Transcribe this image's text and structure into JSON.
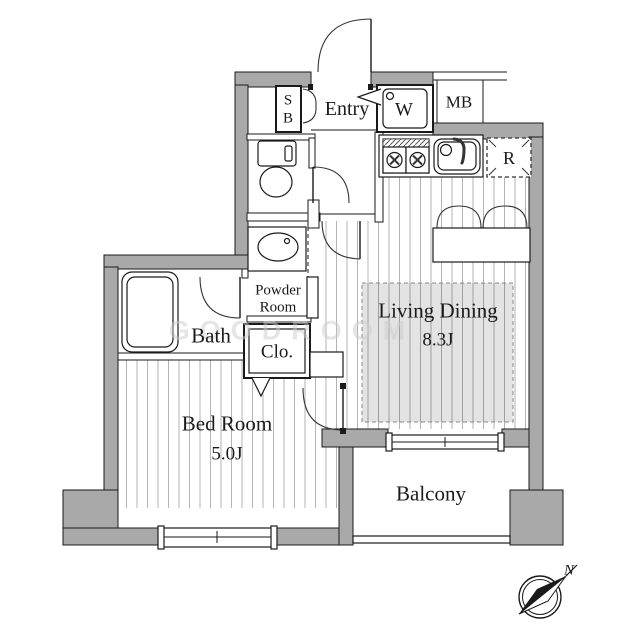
{
  "plan": {
    "watermark": "GOODROOM",
    "compass": {
      "north_label": "N"
    },
    "rooms": {
      "entry": {
        "label": "Entry"
      },
      "shoe_box": {
        "line1": "S",
        "line2": "B"
      },
      "washer": {
        "label": "W"
      },
      "meter_box": {
        "label": "MB"
      },
      "refrigerator": {
        "label": "R"
      },
      "powder_room": {
        "line1": "Powder",
        "line2": "Room"
      },
      "closet": {
        "label": "Clo."
      },
      "bath": {
        "label": "Bath"
      },
      "bedroom": {
        "label": "Bed Room",
        "size": "5.0J"
      },
      "living_dining": {
        "label": "Living Dining",
        "size": "8.3J"
      },
      "balcony": {
        "label": "Balcony"
      }
    },
    "colors": {
      "wall": "#a9a9a9",
      "line": "#1a1a1a",
      "floor_line": "#b3b3b3",
      "shade_border": "#888888"
    }
  }
}
